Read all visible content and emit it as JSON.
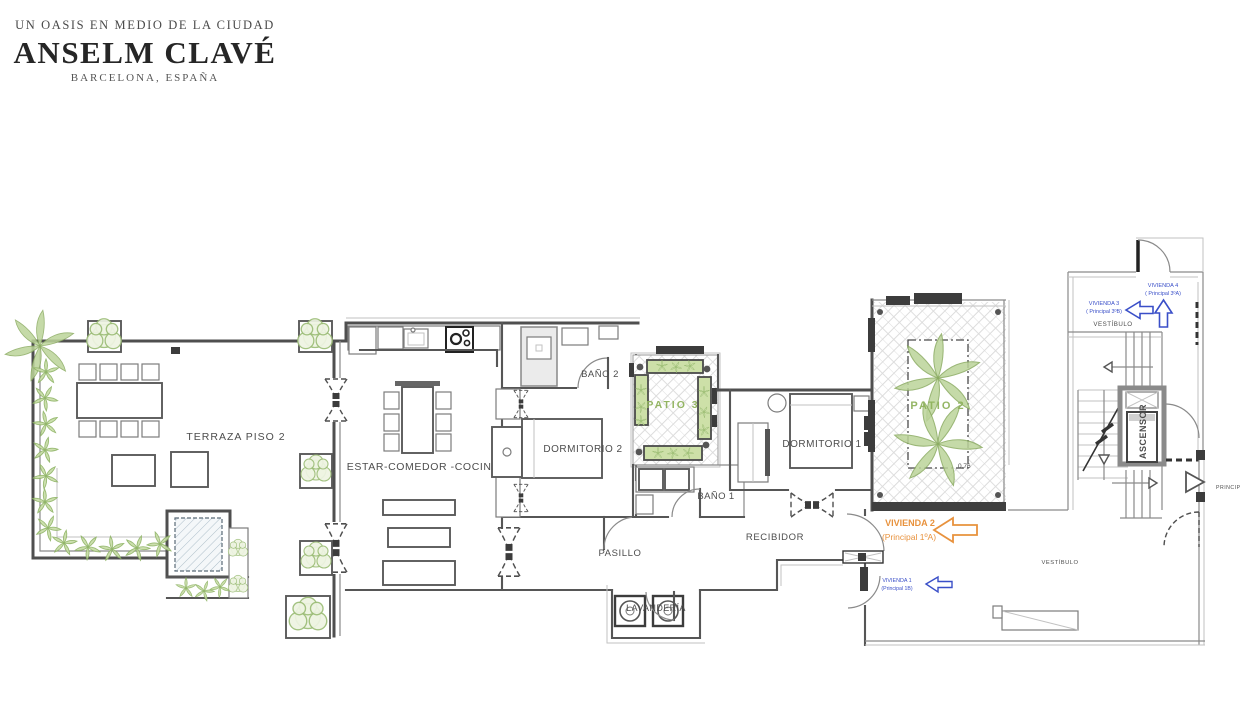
{
  "header": {
    "tagline": "UN OASIS EN MEDIO DE LA CIUDAD",
    "title": "ANSELM CLAVÉ",
    "location": "BARCELONA, ESPAÑA"
  },
  "rooms": {
    "terraza": "TERRAZA PISO 2",
    "estar": "ESTAR-COMEDOR -COCINA",
    "dormitorio2": "DORMITORIO 2",
    "bano2": "BAÑO 2",
    "patio3": "PATIO 3",
    "bano1": "BAÑO 1",
    "dormitorio1": "DORMITORIO 1",
    "patio2": "PATIO 2",
    "recibidor": "RECIBIDOR",
    "pasillo": "PASILLO",
    "lavanderia": "LAVANDERÍA",
    "vestibulo_upper": "VESTÍBULO",
    "vestibulo_lower": "VESTÍBULO",
    "ascensor": "ASCENSOR"
  },
  "annotations": {
    "vivienda4": {
      "name": "VIVIENDA 4",
      "detail": "( Principal 3ºA)"
    },
    "vivienda3": {
      "name": "VIVIENDA 3",
      "detail": "( Principal 3ºB)"
    },
    "vivienda2": {
      "name": "VIVIENDA 2",
      "detail": "(Principal 1ºA)"
    },
    "vivienda1": {
      "name": "VIVIENDA 1",
      "detail": "(Principal 1B)"
    },
    "dimension": "0,76",
    "edge_label": "PRINCIPAL"
  },
  "colors": {
    "annotation_blue": "#3a4fc8",
    "annotation_orange": "#e8923d",
    "plan_green": "#8fb25c",
    "wall_gray": "#4f4f4f"
  }
}
